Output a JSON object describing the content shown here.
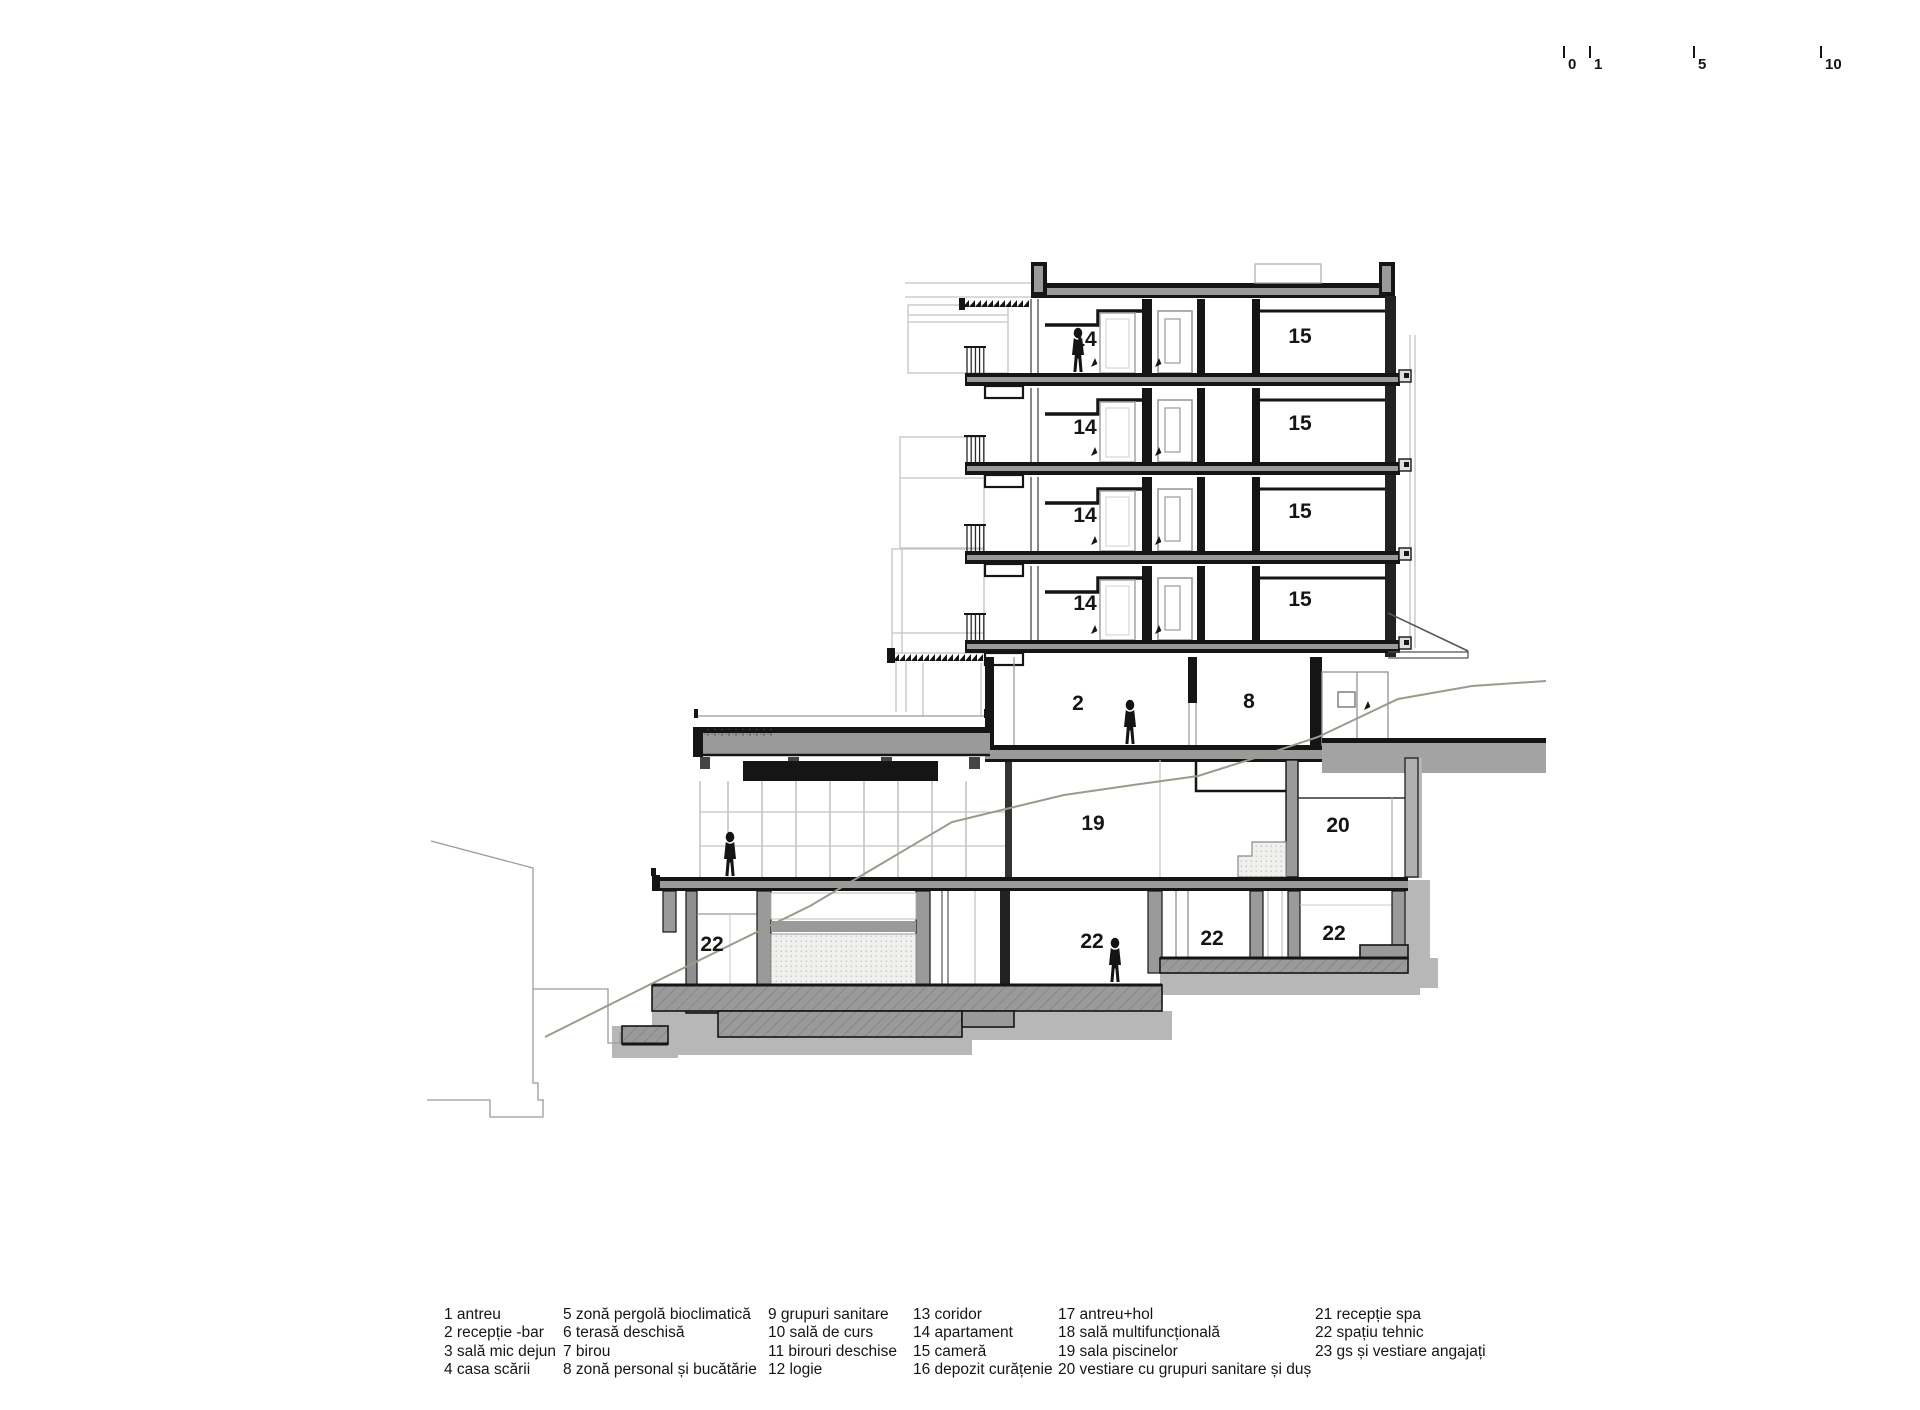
{
  "page": {
    "title": "Secțiune arhitecturală — hotel pe teren în pantă"
  },
  "scale_bar": {
    "ticks": [
      "0",
      "1",
      "5",
      "10"
    ]
  },
  "drawing": {
    "colors": {
      "ink": "#151515",
      "poche": "#9a9a9a",
      "ground_shadow": "#b7b7b7",
      "outline": "#c4c4c4",
      "terrain": "#9a9a8d"
    },
    "room_labels": [
      {
        "text": "14",
        "x": 1085,
        "y": 346
      },
      {
        "text": "15",
        "x": 1300,
        "y": 343
      },
      {
        "text": "14",
        "x": 1085,
        "y": 434
      },
      {
        "text": "15",
        "x": 1300,
        "y": 430
      },
      {
        "text": "14",
        "x": 1085,
        "y": 522
      },
      {
        "text": "15",
        "x": 1300,
        "y": 518
      },
      {
        "text": "14",
        "x": 1085,
        "y": 610
      },
      {
        "text": "15",
        "x": 1300,
        "y": 606
      },
      {
        "text": "2",
        "x": 1078,
        "y": 710
      },
      {
        "text": "8",
        "x": 1249,
        "y": 708
      },
      {
        "text": "19",
        "x": 1093,
        "y": 830
      },
      {
        "text": "20",
        "x": 1338,
        "y": 832
      },
      {
        "text": "22",
        "x": 712,
        "y": 951
      },
      {
        "text": "22",
        "x": 1092,
        "y": 948
      },
      {
        "text": "22",
        "x": 1212,
        "y": 945
      },
      {
        "text": "22",
        "x": 1334,
        "y": 940
      }
    ]
  },
  "legend": {
    "columns": [
      [
        "1 antreu",
        "2 recepție -bar",
        "3 sală mic dejun",
        "4 casa scării"
      ],
      [
        "5 zonă pergolă bioclimatică",
        "6 terasă deschisă",
        "7 birou",
        "8 zonă personal și bucătărie"
      ],
      [
        "9 grupuri sanitare",
        "10 sală de curs",
        "11 birouri deschise",
        "12 logie"
      ],
      [
        "13 coridor",
        "14 apartament",
        "15 cameră",
        "16 depozit curățenie"
      ],
      [
        "17 antreu+hol",
        "18 sală multifuncțională",
        "19 sala piscinelor",
        "20 vestiare cu grupuri sanitare și duș"
      ],
      [
        "21 recepție spa",
        "22 spațiu tehnic",
        "23 gs și vestiare angajați"
      ]
    ]
  }
}
